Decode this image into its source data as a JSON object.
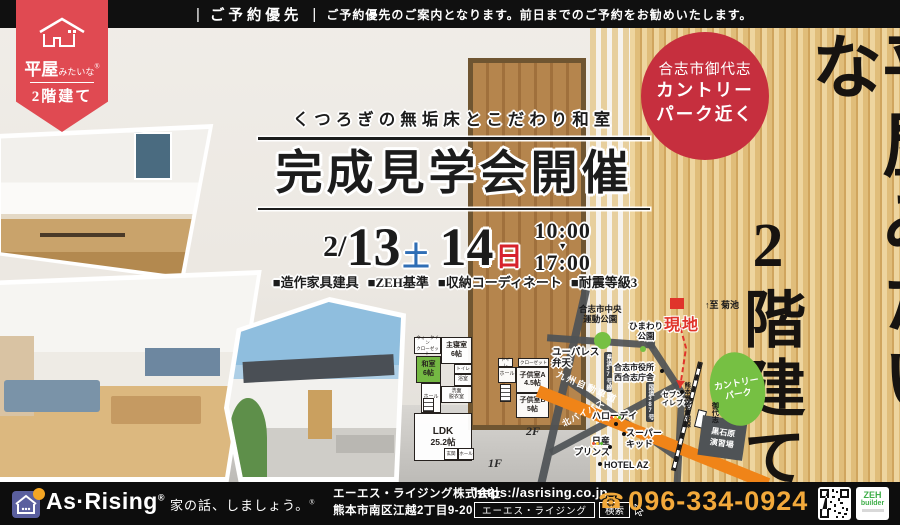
{
  "top_bar": {
    "divider": "|",
    "label": "ご予約優先",
    "note": "ご予約優先のご案内となります。前日までのご予約をお勧めいたします。"
  },
  "ribbon": {
    "brand_large": "平屋",
    "brand_small": "みたいな",
    "reg": "®",
    "brand_line2": "2階建て"
  },
  "headline": {
    "subtitle": "くつろぎの無垢床とこだわり和室",
    "title": "完成見学会開催"
  },
  "event": {
    "month": "2/",
    "day1": "13",
    "day1_wd": "土",
    "day2": "14",
    "day2_wd": "日",
    "time_start": "10:00",
    "time_arrow": "▼",
    "time_end": "17:00",
    "features": [
      "■造作家具建具",
      "■ZEH基準",
      "■収納コーディネート",
      "■耐震等級3"
    ]
  },
  "badge": {
    "line1": "合志市御代志",
    "line2": "カントリー",
    "line3": "パーク近く"
  },
  "vertical_copy": {
    "col_right": "平屋みたいな",
    "col_left": "2階建て"
  },
  "floorplan": {
    "f1": {
      "wic1": "ウォークイン",
      "wic2": "クローゼット",
      "master": "主寝室",
      "master_size": "6帖",
      "washitsu": "和室",
      "washitsu_size": "6帖",
      "toilet": "トイレ",
      "bath": "浴室",
      "wash1": "洗面",
      "wash2": "脱衣室",
      "hall": "ホール",
      "ldk": "LDK",
      "ldk_size": "25.2帖",
      "entrance": "玄関",
      "hall2": "ホール",
      "label": "1F"
    },
    "f2": {
      "toilet": "トイレ",
      "closet": "クローゼット",
      "hall": "ホール",
      "kids_a": "子供室A",
      "kids_a_size": "4.5帖",
      "kids_b": "子供室B",
      "kids_b_size": "5帖",
      "label": "2F"
    }
  },
  "map": {
    "sports_park1": "合志市中央",
    "sports_park2": "運動公園",
    "himawari1": "ひまわり",
    "himawari2": "公園",
    "site": "現地",
    "to_kikuchi": "↑至 菊池",
    "yupalace1": "ユーパレス",
    "yupalace2": "弁天",
    "cityhall1": "合志市役所",
    "cityhall2": "西合志庁舎",
    "seven1": "セブン",
    "seven2": "イレブン",
    "country1": "カントリー",
    "country2": "パーク",
    "expressway": "九州自動車道",
    "pref_road": "県道37号線",
    "route": "国道387号",
    "railway": "熊本電鉄菊池線",
    "station": "御代志",
    "bypass": "北バイパス",
    "halloday": "ハローデイ",
    "superkid1": "スーパー",
    "superkid2": "キッド",
    "nissan1": "日産",
    "nissan2": "プリンス",
    "hotel": "HOTEL AZ",
    "drill1": "黒石原",
    "drill2": "演習場"
  },
  "footer": {
    "brand": "As·Rising",
    "brand_reg": "®",
    "tagline": "家の話、しましょう。",
    "tagline_reg": "®",
    "company": "エーエス・ライジング株式会社",
    "address": "熊本市南区江越2丁目9-20",
    "url": "https://asrising.co.jp",
    "search_query": "エーエス・ライジング",
    "search_button": "検索",
    "phone_icon": "☎",
    "phone": "096-334-0924",
    "zeh_main": "ZEH",
    "zeh_sub": "builder"
  },
  "colors": {
    "ribbon_red": "#e04a52",
    "badge_red": "#c62f3e",
    "site_red": "#e0342b",
    "day_sat_blue": "#2f6eb5",
    "day_sun_red": "#d7222c",
    "phone_amber": "#f2a93b",
    "park_green": "#76c043",
    "expressway_orange": "#f08418",
    "washitsu_green": "#74b843",
    "zeh_green": "#3fae49",
    "logo_purple": "#5a5f9e"
  }
}
